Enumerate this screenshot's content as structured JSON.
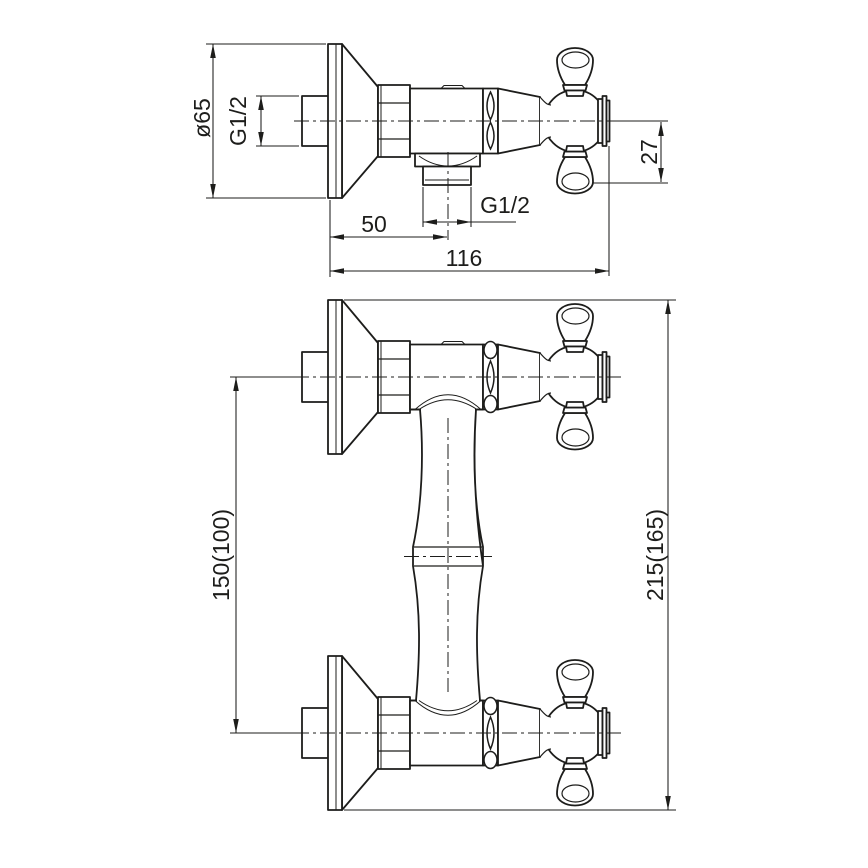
{
  "drawing": {
    "background": "#ffffff",
    "line_color": "#1d1d1b",
    "type": "faucet-installation-dimension-drawing",
    "views": [
      {
        "id": "top-view",
        "description": "side profile: wall flange, valve body, bottom outlet, cross handle"
      },
      {
        "id": "front-view",
        "description": "front elevation: two wall-mounted valves joined by vase-shaped column"
      }
    ],
    "dimensions": {
      "flange_diameter": "ø65",
      "inlet_thread": "G1/2",
      "outlet_thread": "G1/2",
      "outlet_offset": "50",
      "overall_depth": "116",
      "handle_drop": "27",
      "port_spacing": "150(100)",
      "overall_height": "215(165)"
    }
  }
}
